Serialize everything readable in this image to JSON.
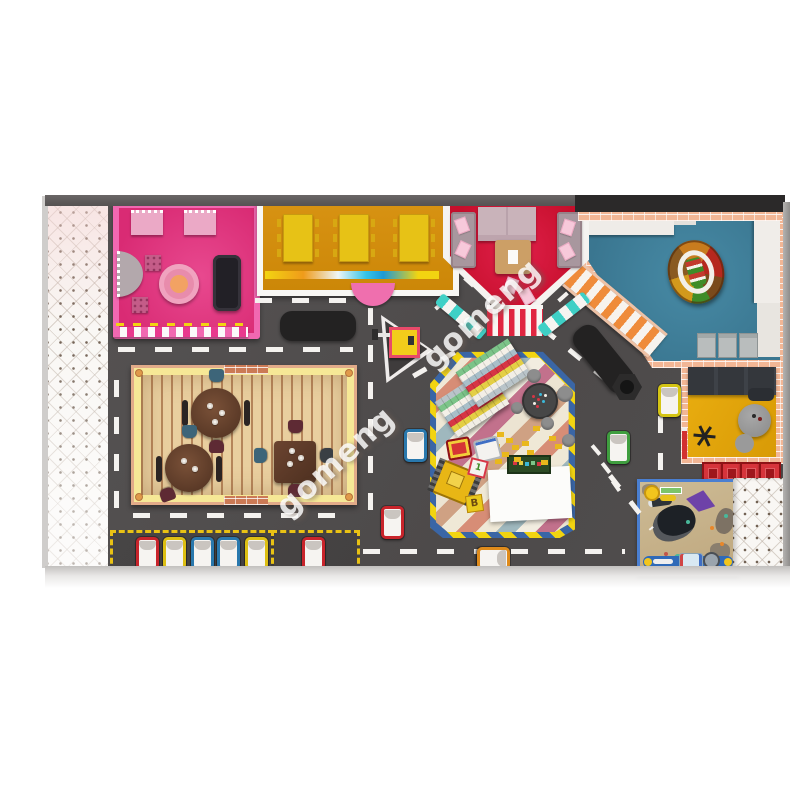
{
  "watermark": {
    "text": "gomeng"
  },
  "blocks": {
    "letter": "B",
    "number": "1"
  },
  "scene": {
    "type": "indoor-playground-floor-plan-top-view",
    "zones": [
      {
        "name": "toddler-room",
        "wall_color": "#f168b1",
        "floor_color": "#dc2f78"
      },
      {
        "name": "dining-room",
        "floor_color": "#d28d0c",
        "table_color": "#e7c216"
      },
      {
        "name": "party-room",
        "floor_color": "#d0142f",
        "wall_color": "#f5f3f0"
      },
      {
        "name": "ball-pit-room",
        "floor_color": "#3f7f9a",
        "wall_color": "#f2b695"
      },
      {
        "name": "lounge-room",
        "floor_color": "#e4a30a"
      },
      {
        "name": "cafe",
        "floor_color": "#e7cda0",
        "trim_color": "#f6e896"
      },
      {
        "name": "block-play-zone",
        "border_color": "#3a66a6",
        "dash_color": "#f2d411"
      },
      {
        "name": "game-projection-mat",
        "frame_color": "#4a7fd1"
      },
      {
        "name": "soft-play-mat",
        "color": "#f9f7f4"
      }
    ],
    "road": {
      "color": "#504d4d",
      "marking_color": "#f4f2ef"
    },
    "vehicles": {
      "parked_colors": [
        "red",
        "yellow",
        "blue",
        "blue",
        "yellow",
        "red"
      ],
      "road_colors": [
        "blue",
        "green",
        "yellow",
        "red",
        "orange"
      ]
    },
    "furniture": {
      "bench_seats": 3,
      "red_stools": 4,
      "gray_chairs": 3
    }
  }
}
